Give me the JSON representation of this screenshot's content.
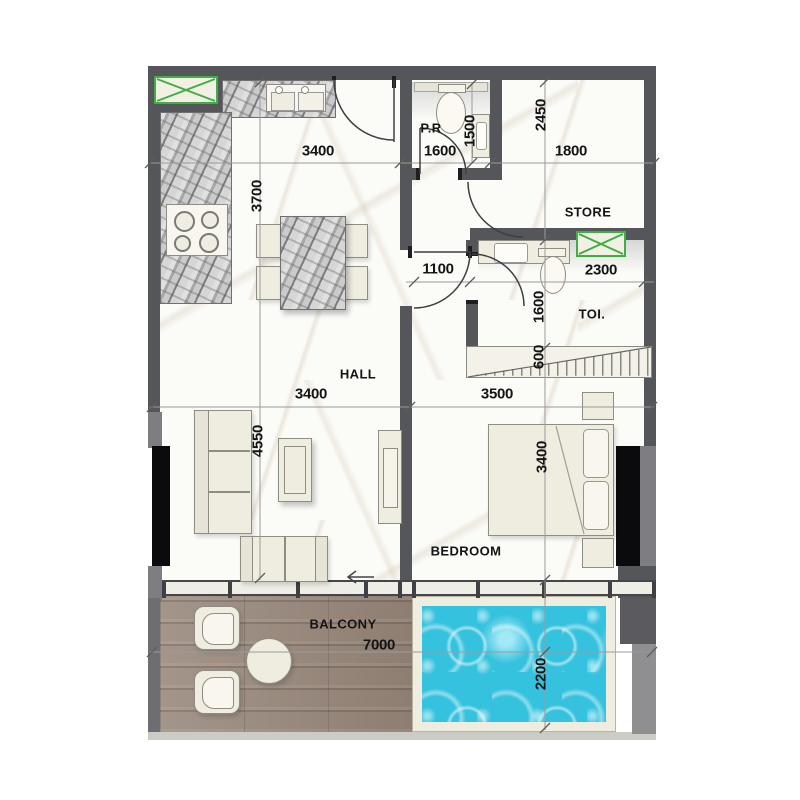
{
  "plan": {
    "rooms": {
      "hall": "HALL",
      "bedroom": "BEDROOM",
      "store": "STORE",
      "toilet": "TOI.",
      "powder_room": "P.R",
      "balcony": "BALCONY"
    },
    "dims": {
      "kitchen_w": "3400",
      "pr_w": "1600",
      "store_w": "1800",
      "kitchen_d": "3700",
      "pr_d": "1500",
      "store_d": "2450",
      "corridor": "1100",
      "toilet_w": "2300",
      "toilet_d": "1600",
      "stair": "600",
      "hall_w": "3400",
      "bedroom_w": "3500",
      "living_d": "4550",
      "bedroom_d": "3400",
      "balcony_w": "7000",
      "pool_d": "2200"
    },
    "colors": {
      "wall": "#55565a",
      "accent_green": "#3fae47",
      "pool_water": "#35c2de",
      "wood": "#9a8a7c",
      "furniture": "#efece0"
    }
  }
}
